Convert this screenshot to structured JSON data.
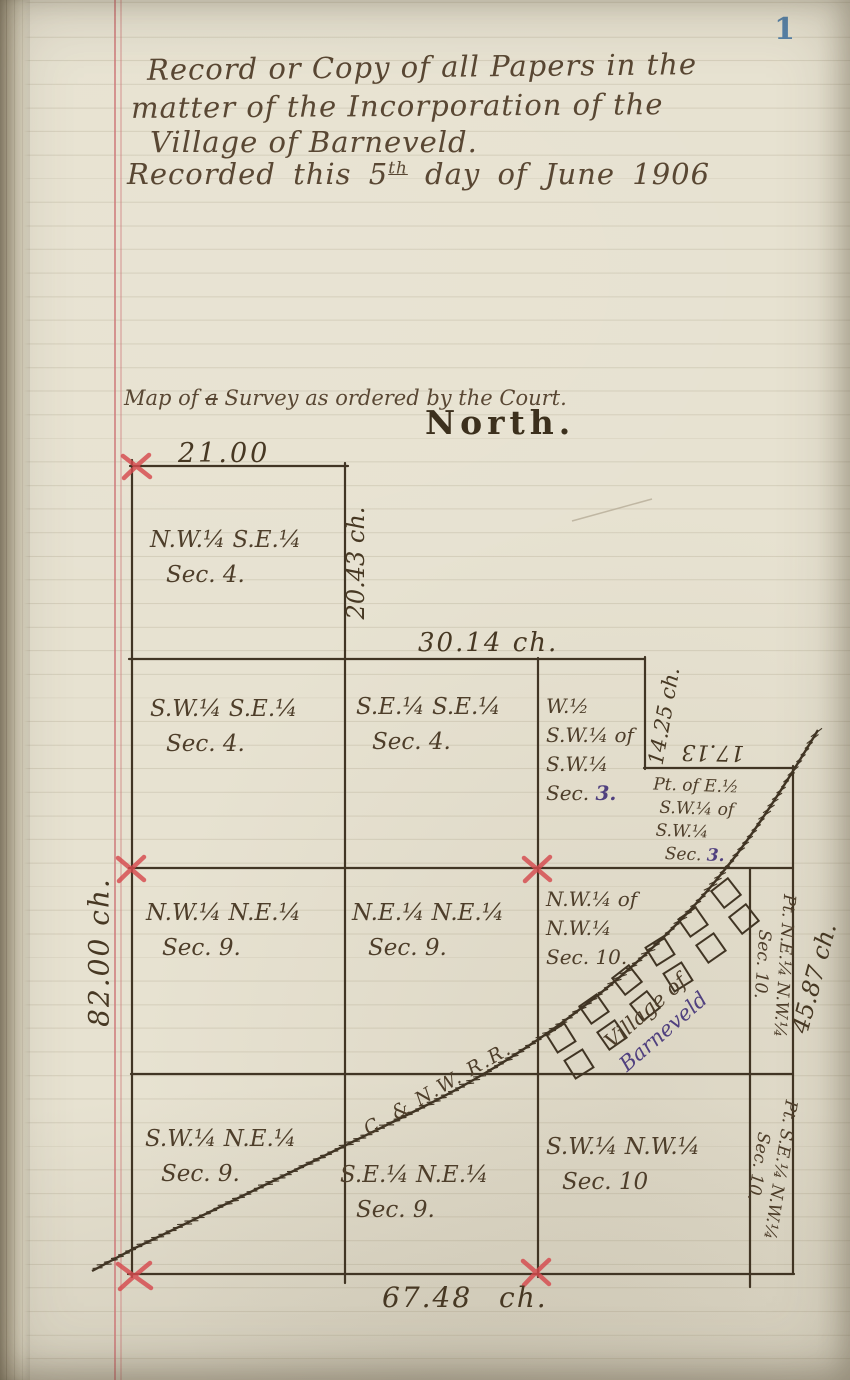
{
  "page": {
    "number": "1",
    "header": {
      "lines": [
        "Record or Copy of all Papers in the",
        "matter of the Incorporation of the",
        "Village of Barneveld."
      ],
      "recorded_line": {
        "prefix": "Recorded this 5",
        "superscript": "th",
        "suffix": " day of June 1906"
      }
    }
  },
  "map": {
    "caption": {
      "prefix": "Map of ",
      "crossed": "a",
      "suffix": " Survey as ordered by the Court."
    },
    "north_label": "North.",
    "railroad_label": "C. & N.W. R.R.",
    "measurements": {
      "top_width": "21.00",
      "ne_side": "20.43 ch.",
      "row2_width": "30.14 ch.",
      "notch_side": "14.25 ch.",
      "notch_width": "17.13",
      "west_side": "82.00 ch.",
      "east_side": "45.87 ch.",
      "south_width": "67.48 ch."
    },
    "cells": {
      "nw_se_4": {
        "lines": [
          "N.W.¼ S.E.¼",
          "Sec. 4."
        ]
      },
      "sw_se_4": {
        "lines": [
          "S.W.¼ S.E.¼",
          "Sec. 4."
        ]
      },
      "se_se_4": {
        "lines": [
          "S.E.¼ S.E.¼",
          "Sec. 4."
        ]
      },
      "w_half_sw_3": {
        "lines": [
          "W.½",
          "S.W.¼ of",
          "S.W.¼"
        ],
        "sec_prefix": "Sec.",
        "sec_num": "3."
      },
      "pt_e_half_sw_3": {
        "lines": [
          "Pt. of E.½",
          "S.W.¼ of",
          "S.W.¼"
        ],
        "sec_prefix": "Sec.",
        "sec_num": "3."
      },
      "nw_ne_9": {
        "lines": [
          "N.W.¼ N.E.¼",
          "Sec. 9."
        ]
      },
      "ne_ne_9": {
        "lines": [
          "N.E.¼ N.E.¼",
          "Sec. 9."
        ]
      },
      "nw_nw_10": {
        "lines": [
          "N.W.¼ of",
          "N.W.¼",
          "Sec. 10."
        ]
      },
      "sw_ne_9": {
        "lines": [
          "S.W.¼ N.E.¼",
          "Sec. 9."
        ]
      },
      "se_ne_9": {
        "lines": [
          "S.E.¼ N.E.¼",
          "Sec. 9."
        ]
      },
      "sw_nw_10": {
        "lines": [
          "S.W.¼ N.W.¼",
          "Sec. 10"
        ]
      },
      "pt_ne_nw_10": {
        "lines": [
          "Pt. N.E.¼ N.W.¼",
          "Sec. 10."
        ]
      },
      "pt_se_nw_10": {
        "lines": [
          "Pt. S.E.¼ N.W.¼",
          "Sec. 10."
        ]
      },
      "village": {
        "lines": [
          "Village of",
          "Barneveld"
        ]
      }
    },
    "colors": {
      "ink": "#413524",
      "red_mark": "#d64a4e",
      "purple_ink": "#50407f",
      "page_number_blue": "#5581a8",
      "margin_red": "#cc7e7e"
    }
  }
}
